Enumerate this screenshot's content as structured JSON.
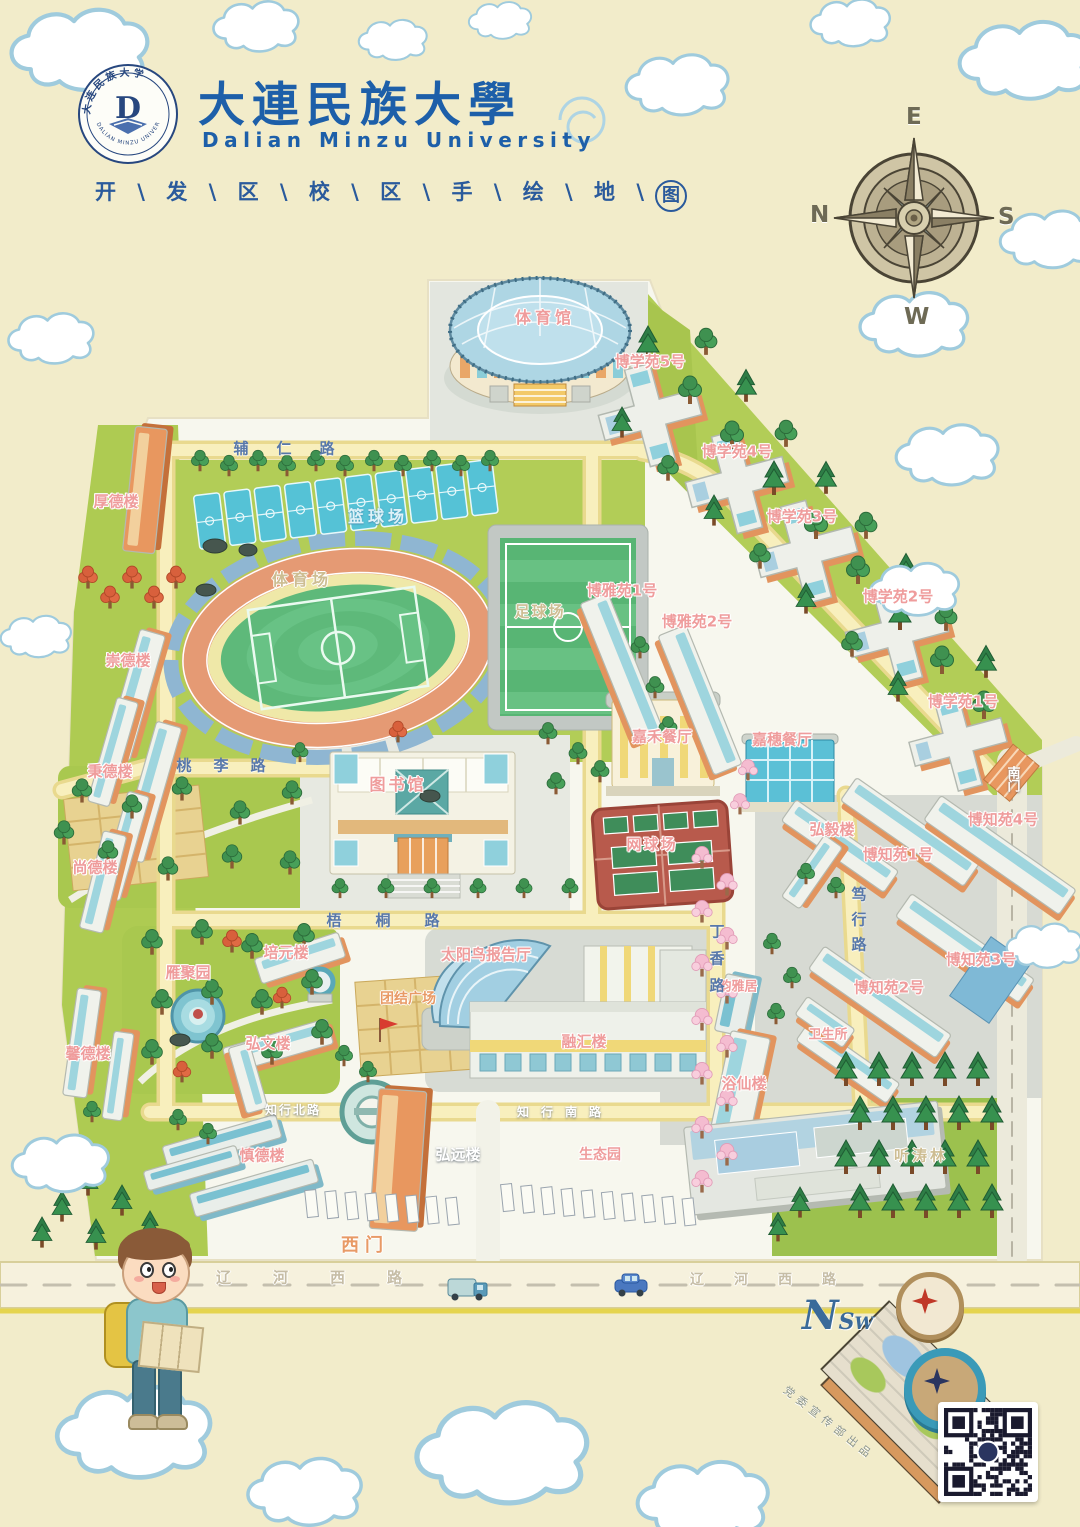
{
  "header": {
    "logo": {
      "letter": "D",
      "seal_top": "大连民族大学",
      "seal_bottom": "DALIAN MINZU UNIVERSITY"
    },
    "title_cn": "大連民族大學",
    "title_en": "Dalian Minzu University",
    "slogan_chars": [
      "开",
      "发",
      "区",
      "校",
      "区",
      "手",
      "绘",
      "地"
    ],
    "slogan_last": "图"
  },
  "compass": {
    "top": "E",
    "right": "S",
    "bottom": "W",
    "left": "N"
  },
  "map": {
    "labels": [
      {
        "t": "体育馆",
        "x": 545,
        "y": 318,
        "c": "pink",
        "s": 16,
        "sp": 4
      },
      {
        "t": "博学苑5号",
        "x": 650,
        "y": 362,
        "c": "pink"
      },
      {
        "t": "博学苑4号",
        "x": 737,
        "y": 452,
        "c": "pink"
      },
      {
        "t": "博学苑3号",
        "x": 802,
        "y": 517,
        "c": "pink"
      },
      {
        "t": "博学苑2号",
        "x": 898,
        "y": 597,
        "c": "pink"
      },
      {
        "t": "博学苑1号",
        "x": 963,
        "y": 702,
        "c": "pink"
      },
      {
        "t": "厚德楼",
        "x": 116,
        "y": 502,
        "c": "pink"
      },
      {
        "t": "崇德楼",
        "x": 128,
        "y": 661,
        "c": "pink"
      },
      {
        "t": "秉德楼",
        "x": 110,
        "y": 772,
        "c": "pink"
      },
      {
        "t": "尚德楼",
        "x": 95,
        "y": 868,
        "c": "pink"
      },
      {
        "t": "馨德楼",
        "x": 88,
        "y": 1054,
        "c": "pink"
      },
      {
        "t": "慎德楼",
        "x": 262,
        "y": 1156,
        "c": "pink"
      },
      {
        "t": "图书馆",
        "x": 398,
        "y": 785,
        "c": "pink",
        "s": 16,
        "sp": 3
      },
      {
        "t": "篮球场",
        "x": 378,
        "y": 517,
        "c": "cyan",
        "s": 16,
        "sp": 4
      },
      {
        "t": "体育场",
        "x": 302,
        "y": 580,
        "c": "tan",
        "s": 16,
        "sp": 4
      },
      {
        "t": "足球场",
        "x": 540,
        "y": 612,
        "c": "tan",
        "s": 15,
        "sp": 2
      },
      {
        "t": "网球场",
        "x": 652,
        "y": 845,
        "c": "pink",
        "s": 15,
        "sp": 2
      },
      {
        "t": "博雅苑1号",
        "x": 622,
        "y": 591,
        "c": "pink"
      },
      {
        "t": "博雅苑2号",
        "x": 697,
        "y": 622,
        "c": "pink"
      },
      {
        "t": "嘉禾餐厅",
        "x": 662,
        "y": 737,
        "c": "pink"
      },
      {
        "t": "嘉穗餐厅",
        "x": 782,
        "y": 740,
        "c": "pink"
      },
      {
        "t": "雁聚园",
        "x": 188,
        "y": 973,
        "c": "pink"
      },
      {
        "t": "培元楼",
        "x": 286,
        "y": 953,
        "c": "pink"
      },
      {
        "t": "弘文楼",
        "x": 268,
        "y": 1044,
        "c": "pink"
      },
      {
        "t": "团结广场",
        "x": 408,
        "y": 999,
        "c": "orange",
        "s": 14
      },
      {
        "t": "太阳鸟报告厅",
        "x": 486,
        "y": 955,
        "c": "pink"
      },
      {
        "t": "融汇楼",
        "x": 584,
        "y": 1042,
        "c": "pink"
      },
      {
        "t": "韵雅居",
        "x": 738,
        "y": 987,
        "c": "pink",
        "s": 13
      },
      {
        "t": "卫生所",
        "x": 828,
        "y": 1035,
        "c": "pink",
        "s": 13
      },
      {
        "t": "浴仙楼",
        "x": 744,
        "y": 1084,
        "c": "pink"
      },
      {
        "t": "弘毅楼",
        "x": 832,
        "y": 830,
        "c": "pink"
      },
      {
        "t": "博知苑1号",
        "x": 898,
        "y": 855,
        "c": "pink"
      },
      {
        "t": "博知苑4号",
        "x": 1003,
        "y": 820,
        "c": "pink"
      },
      {
        "t": "博知苑3号",
        "x": 981,
        "y": 960,
        "c": "pink"
      },
      {
        "t": "博知苑2号",
        "x": 889,
        "y": 988,
        "c": "pink"
      },
      {
        "t": "弘远楼",
        "x": 458,
        "y": 1155,
        "c": "white"
      },
      {
        "t": "生态园",
        "x": 600,
        "y": 1155,
        "c": "pink",
        "s": 14
      },
      {
        "t": "听涛林",
        "x": 921,
        "y": 1156,
        "c": "tan",
        "s": 15,
        "sp": 3
      },
      {
        "t": "西门",
        "x": 365,
        "y": 1246,
        "c": "orange",
        "s": 18,
        "sp": 6
      },
      {
        "t": "南门",
        "x": 1012,
        "y": 779,
        "c": "white",
        "v": true,
        "s": 13
      },
      {
        "t": "辅仁路",
        "x": 298,
        "y": 449,
        "c": "blue",
        "sp": 28
      },
      {
        "t": "桃李路",
        "x": 232,
        "y": 766,
        "c": "blue",
        "sp": 22
      },
      {
        "t": "梧桐路",
        "x": 400,
        "y": 921,
        "c": "blue",
        "sp": 34
      },
      {
        "t": "丁香路",
        "x": 716,
        "y": 964,
        "c": "blue",
        "v": true,
        "sp": 12
      },
      {
        "t": "笃行路",
        "x": 858,
        "y": 924,
        "c": "blue",
        "v": true,
        "sp": 10
      },
      {
        "t": "知行北路",
        "x": 293,
        "y": 1110,
        "c": "white",
        "s": 12,
        "sp": 2
      },
      {
        "t": "知行南路",
        "x": 565,
        "y": 1112,
        "c": "white",
        "s": 12,
        "sp": 12
      },
      {
        "t": "辽河西路",
        "x": 330,
        "y": 1278,
        "c": "roadgrey",
        "s": 15,
        "sp": 42
      },
      {
        "t": "辽河西路",
        "x": 778,
        "y": 1280,
        "c": "roadgrey",
        "s": 14,
        "sp": 30
      }
    ]
  },
  "footer": {
    "minimap_letters": {
      "n": "N",
      "s": "S",
      "w": "W"
    },
    "credit": "党委宣传部出品"
  },
  "colors": {
    "title_blue": "#1d5fa9",
    "label_pink": "#ef9c9c",
    "road_blue": "#5878aa",
    "lawn_green": "#b2cd57",
    "track_orange": "#e59a74",
    "court_cyan": "#55c2d6",
    "bg_cream": "#f2ecca"
  }
}
